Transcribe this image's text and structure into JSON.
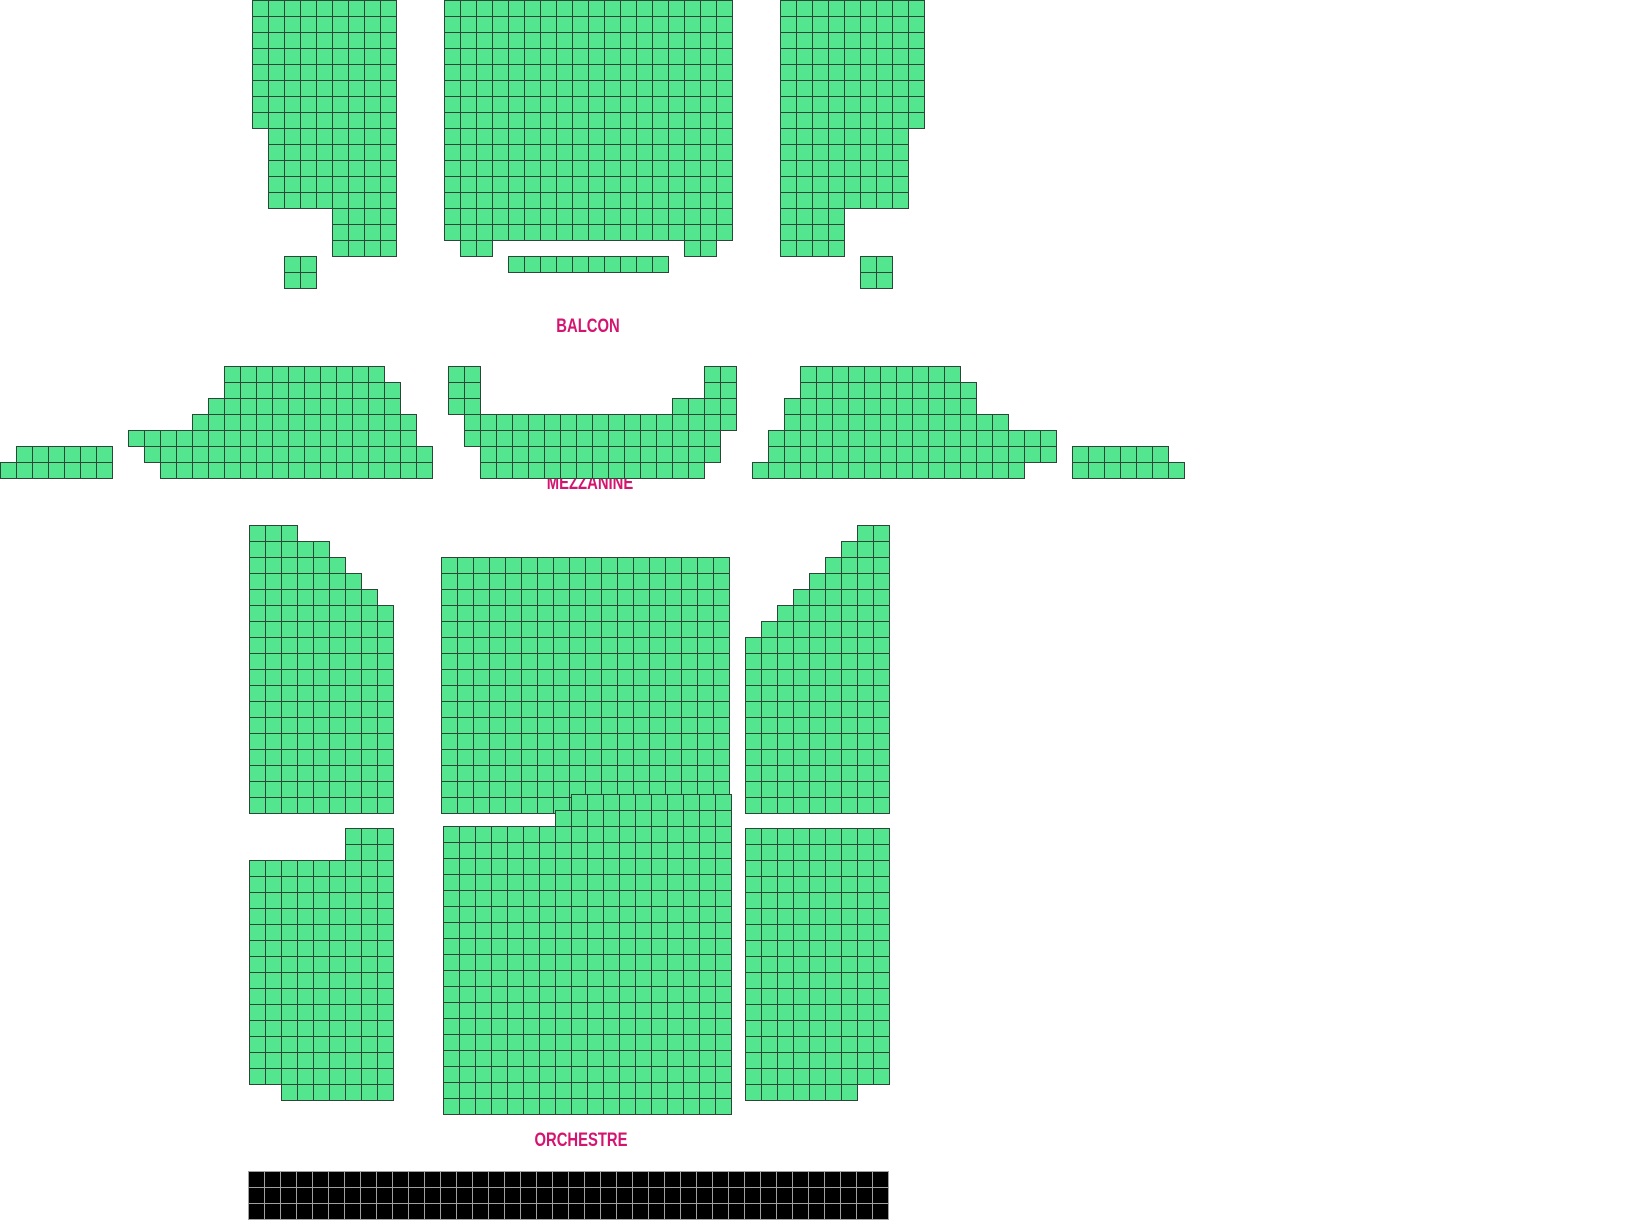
{
  "title": "Theater seating map",
  "canvas": {
    "width": 1626,
    "height": 1220,
    "background": "#ffffff"
  },
  "seat": {
    "size": 16,
    "fill": "#54e68f",
    "border": "#2c4737"
  },
  "label_color": "#d4146f",
  "sections": [
    {
      "id": "balcon",
      "label": "BALCON",
      "label_x": 588,
      "label_y": 318,
      "blocks": [
        {
          "name": "balcon-left",
          "x": 252,
          "y": 0,
          "rows": [
            {
              "r": [
                0,
                7
              ],
              "spans": [
                [
                  0,
                  9
                ]
              ]
            },
            {
              "r": [
                8,
                12
              ],
              "spans": [
                [
                  1,
                  9
                ]
              ]
            },
            {
              "r": [
                13,
                15
              ],
              "spans": [
                [
                  5,
                  9
                ]
              ]
            },
            {
              "r": [
                16,
                17
              ],
              "spans": [
                [
                  2,
                  4
                ]
              ]
            }
          ]
        },
        {
          "name": "balcon-center",
          "x": 444,
          "y": 0,
          "rows": [
            {
              "r": [
                0,
                14
              ],
              "spans": [
                [
                  0,
                  18
                ]
              ]
            },
            {
              "r": [
                15,
                15
              ],
              "spans": [
                [
                  1,
                  3
                ],
                [
                  15,
                  17
                ]
              ]
            },
            {
              "r": [
                16,
                16
              ],
              "spans": [
                [
                  4,
                  14
                ]
              ]
            }
          ]
        },
        {
          "name": "balcon-right",
          "x": 780,
          "y": 0,
          "rows": [
            {
              "r": [
                0,
                7
              ],
              "spans": [
                [
                  0,
                  9
                ]
              ]
            },
            {
              "r": [
                8,
                12
              ],
              "spans": [
                [
                  0,
                  8
                ]
              ]
            },
            {
              "r": [
                13,
                15
              ],
              "spans": [
                [
                  0,
                  4
                ]
              ]
            },
            {
              "r": [
                16,
                17
              ],
              "spans": [
                [
                  5,
                  7
                ]
              ]
            }
          ]
        }
      ]
    },
    {
      "id": "mezzanine",
      "label": "MEZZANINE",
      "label_x": 590,
      "label_y": 475,
      "blocks": [
        {
          "name": "mezzanine-far-left",
          "x": 0,
          "y": 366,
          "rows": [
            {
              "r": [
                5,
                5
              ],
              "spans": [
                [
                  1,
                  7
                ]
              ]
            },
            {
              "r": [
                6,
                6
              ],
              "spans": [
                [
                  0,
                  7
                ]
              ]
            }
          ]
        },
        {
          "name": "mezzanine-left",
          "x": 128,
          "y": 366,
          "rows": [
            {
              "r": [
                0,
                0
              ],
              "spans": [
                [
                  6,
                  16
                ]
              ]
            },
            {
              "r": [
                1,
                1
              ],
              "spans": [
                [
                  6,
                  17
                ]
              ]
            },
            {
              "r": [
                2,
                2
              ],
              "spans": [
                [
                  5,
                  17
                ]
              ]
            },
            {
              "r": [
                3,
                3
              ],
              "spans": [
                [
                  4,
                  18
                ]
              ]
            },
            {
              "r": [
                4,
                4
              ],
              "spans": [
                [
                  0,
                  18
                ]
              ]
            },
            {
              "r": [
                5,
                5
              ],
              "spans": [
                [
                  1,
                  19
                ]
              ]
            },
            {
              "r": [
                6,
                6
              ],
              "spans": [
                [
                  2,
                  19
                ]
              ]
            }
          ]
        },
        {
          "name": "mezzanine-center",
          "x": 448,
          "y": 366,
          "rows": [
            {
              "r": [
                0,
                1
              ],
              "spans": [
                [
                  0,
                  2
                ],
                [
                  16,
                  18
                ]
              ]
            },
            {
              "r": [
                2,
                2
              ],
              "spans": [
                [
                  0,
                  2
                ],
                [
                  14,
                  18
                ]
              ]
            },
            {
              "r": [
                3,
                3
              ],
              "spans": [
                [
                  1,
                  18
                ]
              ]
            },
            {
              "r": [
                4,
                4
              ],
              "spans": [
                [
                  1,
                  17
                ]
              ]
            },
            {
              "r": [
                5,
                5
              ],
              "spans": [
                [
                  2,
                  17
                ]
              ]
            },
            {
              "r": [
                6,
                6
              ],
              "spans": [
                [
                  2,
                  16
                ]
              ]
            }
          ]
        },
        {
          "name": "mezzanine-right",
          "x": 752,
          "y": 366,
          "rows": [
            {
              "r": [
                0,
                0
              ],
              "spans": [
                [
                  3,
                  13
                ]
              ]
            },
            {
              "r": [
                1,
                1
              ],
              "spans": [
                [
                  3,
                  14
                ]
              ]
            },
            {
              "r": [
                2,
                2
              ],
              "spans": [
                [
                  2,
                  14
                ]
              ]
            },
            {
              "r": [
                3,
                3
              ],
              "spans": [
                [
                  2,
                  16
                ]
              ]
            },
            {
              "r": [
                4,
                5
              ],
              "spans": [
                [
                  1,
                  19
                ]
              ]
            },
            {
              "r": [
                6,
                6
              ],
              "spans": [
                [
                  0,
                  17
                ]
              ]
            }
          ]
        },
        {
          "name": "mezzanine-far-right",
          "x": 1072,
          "y": 366,
          "rows": [
            {
              "r": [
                5,
                5
              ],
              "spans": [
                [
                  0,
                  6
                ]
              ]
            },
            {
              "r": [
                6,
                6
              ],
              "spans": [
                [
                  0,
                  7
                ]
              ]
            }
          ]
        }
      ]
    },
    {
      "id": "orchestre",
      "label": "ORCHESTRE",
      "label_x": 581,
      "label_y": 1132,
      "blocks": [
        {
          "name": "orchestre-upper-left",
          "x": 249,
          "y": 525,
          "rows": [
            {
              "r": [
                0,
                0
              ],
              "spans": [
                [
                  0,
                  3
                ]
              ]
            },
            {
              "r": [
                1,
                1
              ],
              "spans": [
                [
                  0,
                  5
                ]
              ]
            },
            {
              "r": [
                2,
                2
              ],
              "spans": [
                [
                  0,
                  6
                ]
              ]
            },
            {
              "r": [
                3,
                3
              ],
              "spans": [
                [
                  0,
                  7
                ]
              ]
            },
            {
              "r": [
                4,
                4
              ],
              "spans": [
                [
                  0,
                  8
                ]
              ]
            },
            {
              "r": [
                5,
                17
              ],
              "spans": [
                [
                  0,
                  9
                ]
              ]
            }
          ]
        },
        {
          "name": "orchestre-upper-center",
          "x": 441,
          "y": 557,
          "rows": [
            {
              "r": [
                0,
                15
              ],
              "spans": [
                [
                  0,
                  18
                ]
              ]
            }
          ]
        },
        {
          "name": "orchestre-upper-right",
          "x": 745,
          "y": 525,
          "rows": [
            {
              "r": [
                0,
                0
              ],
              "spans": [
                [
                  7,
                  9
                ]
              ]
            },
            {
              "r": [
                1,
                1
              ],
              "spans": [
                [
                  6,
                  9
                ]
              ]
            },
            {
              "r": [
                2,
                2
              ],
              "spans": [
                [
                  5,
                  9
                ]
              ]
            },
            {
              "r": [
                3,
                3
              ],
              "spans": [
                [
                  4,
                  9
                ]
              ]
            },
            {
              "r": [
                4,
                4
              ],
              "spans": [
                [
                  3,
                  9
                ]
              ]
            },
            {
              "r": [
                5,
                5
              ],
              "spans": [
                [
                  2,
                  9
                ]
              ]
            },
            {
              "r": [
                6,
                6
              ],
              "spans": [
                [
                  1,
                  9
                ]
              ]
            },
            {
              "r": [
                7,
                17
              ],
              "spans": [
                [
                  0,
                  9
                ]
              ]
            }
          ]
        },
        {
          "name": "orchestre-lower-left",
          "x": 249,
          "y": 828,
          "rows": [
            {
              "r": [
                0,
                1
              ],
              "spans": [
                [
                  6,
                  9
                ]
              ]
            },
            {
              "r": [
                2,
                15
              ],
              "spans": [
                [
                  0,
                  9
                ]
              ]
            },
            {
              "r": [
                16,
                16
              ],
              "spans": [
                [
                  2,
                  9
                ]
              ]
            }
          ]
        },
        {
          "name": "orchestre-lower-center",
          "x": 443,
          "y": 794,
          "rows": [
            {
              "r": [
                0,
                0
              ],
              "spans": [
                [
                  8,
                  18
                ]
              ]
            },
            {
              "r": [
                1,
                1
              ],
              "spans": [
                [
                  7,
                  18
                ]
              ]
            },
            {
              "r": [
                2,
                19
              ],
              "spans": [
                [
                  0,
                  18
                ]
              ]
            }
          ]
        },
        {
          "name": "orchestre-lower-right",
          "x": 745,
          "y": 828,
          "rows": [
            {
              "r": [
                0,
                15
              ],
              "spans": [
                [
                  0,
                  9
                ]
              ]
            },
            {
              "r": [
                16,
                16
              ],
              "spans": [
                [
                  0,
                  7
                ]
              ]
            }
          ]
        }
      ]
    }
  ],
  "stage": {
    "x": 248,
    "y": 1171,
    "cols": 40,
    "rows": 3,
    "cell": 16,
    "fill": "#000000",
    "border": "#a0a0a0"
  }
}
